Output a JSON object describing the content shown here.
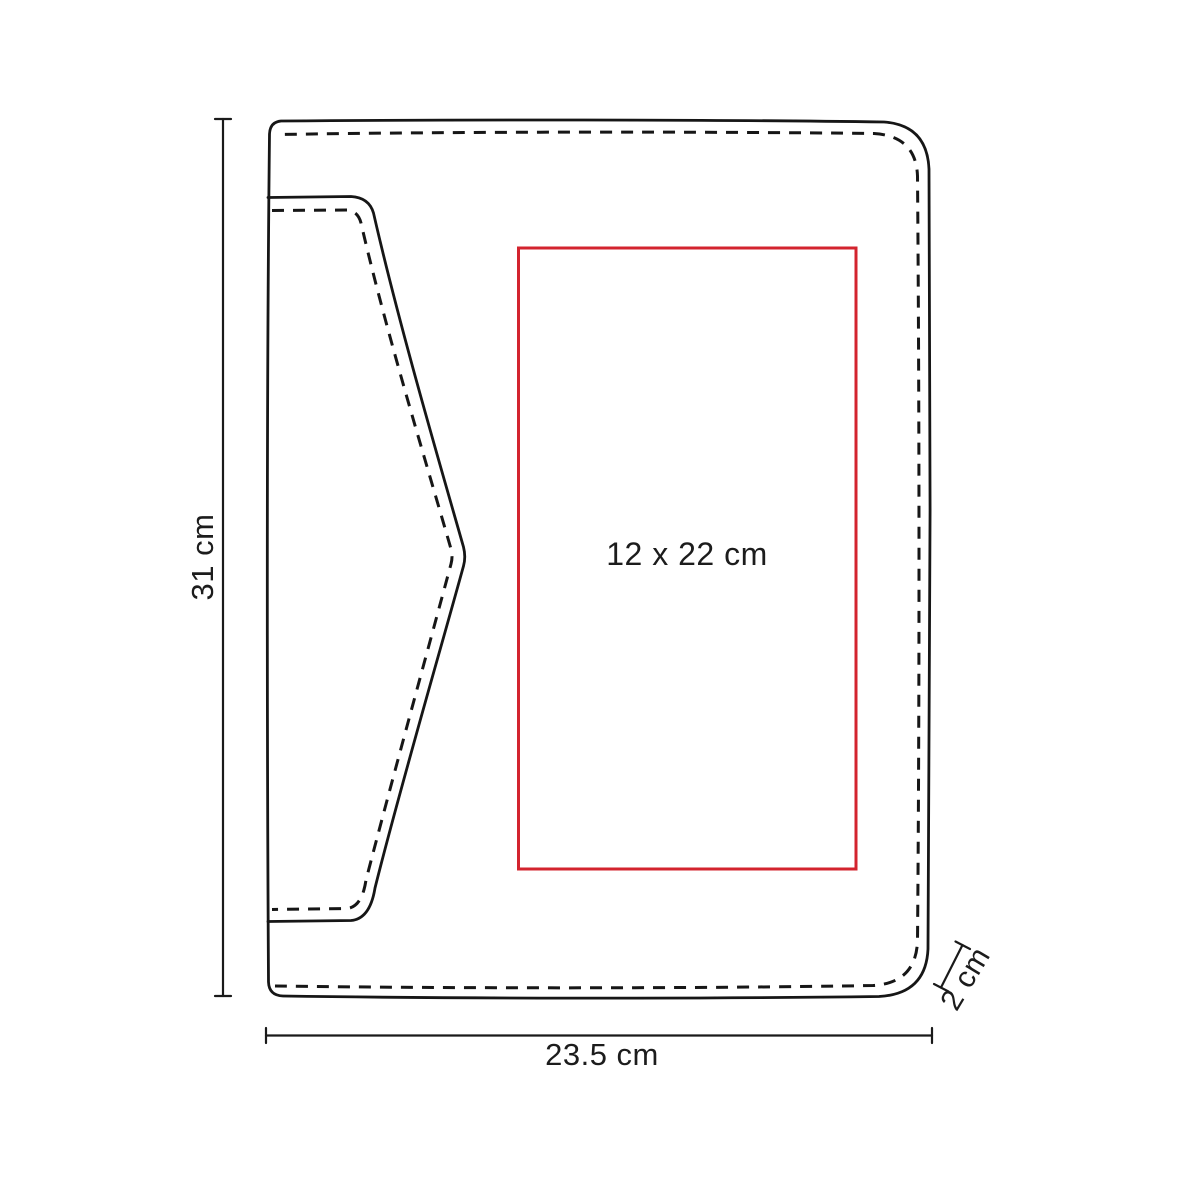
{
  "diagram": {
    "labels": {
      "height": "31 cm",
      "width": "23.5 cm",
      "depth": "2 cm",
      "print_area": "12 x 22 cm"
    },
    "values": {
      "height_cm": 31,
      "width_cm": 23.5,
      "depth_cm": 2,
      "print_area_cm": "12 x 22"
    },
    "colors": {
      "line": "#161616",
      "dimension": "#1a1a1a",
      "print_area": "#d3232e",
      "text": "#1c1c1c",
      "background": "#ffffff"
    }
  }
}
